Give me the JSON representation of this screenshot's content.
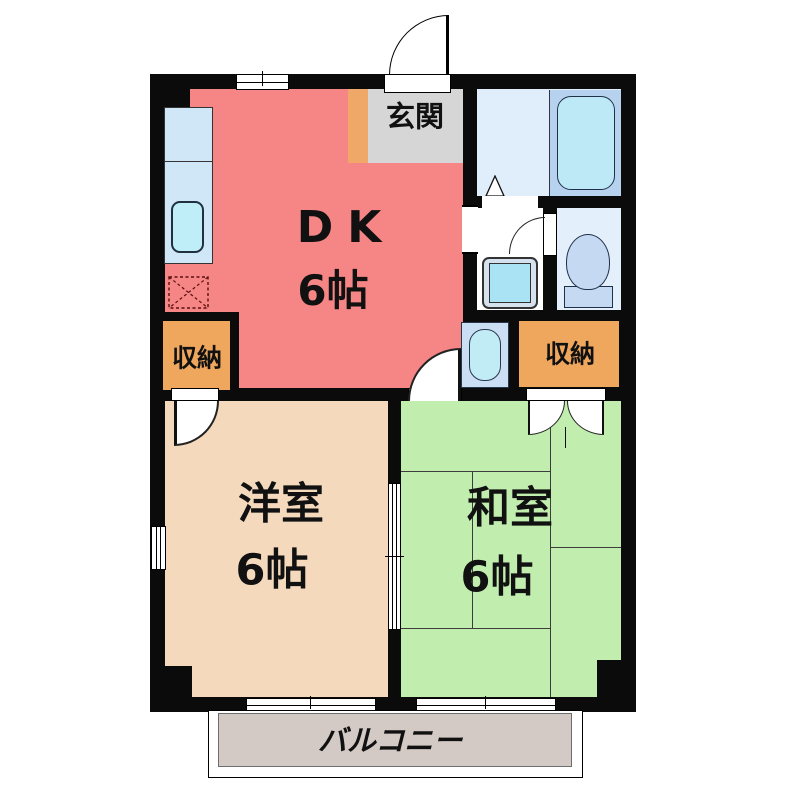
{
  "plan": {
    "dk": {
      "name": "DK",
      "size": "6帖"
    },
    "western_room": {
      "name": "洋室",
      "size": "6帖"
    },
    "japanese_room": {
      "name": "和室",
      "size": "6帖"
    },
    "entrance": {
      "label": "玄関"
    },
    "storage_left": {
      "label": "収納"
    },
    "storage_right": {
      "label": "収納"
    },
    "balcony": {
      "label": "バルコニー"
    }
  },
  "colors": {
    "wall": "#0b0b0b",
    "dk_floor": "#f68585",
    "western_floor": "#f4d9bd",
    "japanese_floor": "#c1eeae",
    "storage": "#efa75e",
    "entrance_floor": "#d6d6d6",
    "entrance_step": "#f0a868",
    "bathroom_floor": "#dfeefa",
    "toilet_floor": "#e3effb",
    "fixture_blue": "#b9e9f6",
    "counter_blue": "#cfe7f7",
    "bathtub_panel": "#b7d2ee",
    "toilet_ceramic": "#c5daf2",
    "balcony_floor": "#d3cac5"
  }
}
